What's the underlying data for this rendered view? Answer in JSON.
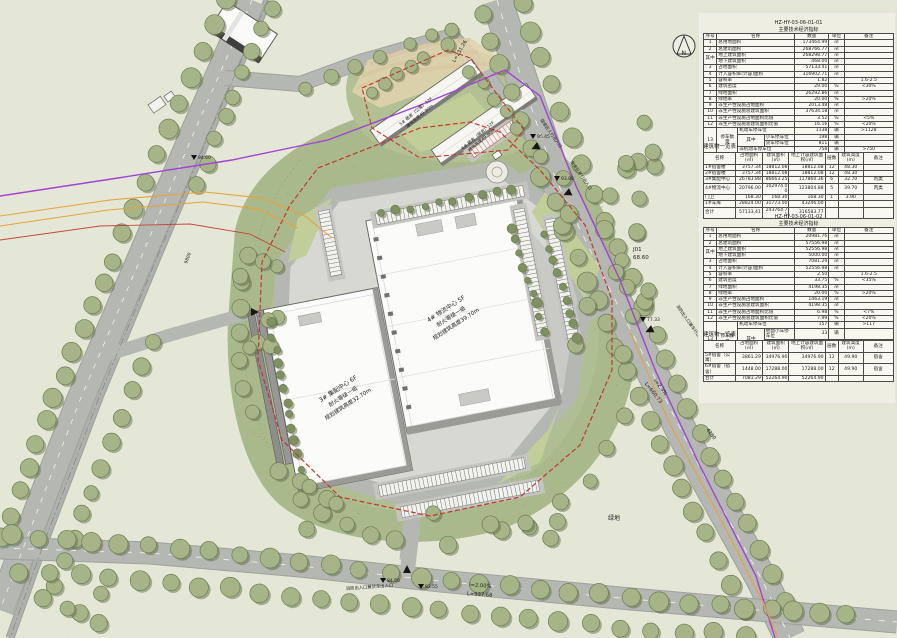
{
  "plan": {
    "north_label": "N",
    "buildings": {
      "b4": {
        "l1": "4# 物流中心 5F",
        "l2": "耐火等级一级",
        "l3": "规划建筑高度39.70m"
      },
      "b3": {
        "l1": "3# 集配中心 6F",
        "l2": "耐火等级一级",
        "l3": "规划建筑高度32.70m"
      },
      "d5": {
        "l1": "5# 宿舍（公寓）12F",
        "l2": "建筑高度49.90m"
      },
      "d6": {
        "l1": "6# 宿舍（宿舍）12F",
        "l2": "建筑高度49.90m"
      }
    },
    "roads": {
      "bottom_slope": "i=2.00%",
      "bottom_len": "L=937.68",
      "right_slope": "i=2.3%",
      "right_len": "L=660.73",
      "top_len": "L=231.26"
    },
    "points": {
      "j01": "J01",
      "j01_elev": "68.60",
      "station": "4280",
      "dim": "9800",
      "green": "绿地"
    },
    "entrances": {
      "e1": "宿舍区人行出入口",
      "e2": "宿舍区车行出入口",
      "e3": "消防出入口兼车行出入口",
      "e4": "消防出入口兼货车出入口"
    },
    "spot_elevations": [
      {
        "x": 194,
        "y": 160,
        "v": "94.60"
      },
      {
        "x": 383,
        "y": 583,
        "v": "84.50"
      },
      {
        "x": 421,
        "y": 589,
        "v": "82.55"
      },
      {
        "x": 643,
        "y": 322,
        "v": "77.33"
      },
      {
        "x": 533,
        "y": 139,
        "v": "95.45"
      },
      {
        "x": 557,
        "y": 181,
        "v": "93.88"
      }
    ]
  },
  "tables": {
    "t1": {
      "code": "HZ-HY-03-06-01-01",
      "title": "主要技术经济指标",
      "w": [
        7,
        11,
        14,
        16,
        18,
        8,
        26
      ],
      "rows": [
        {
          "h": true,
          "c": [
            {
              "t": "序号"
            },
            {
              "t": "名称",
              "cs": 3
            },
            {
              "t": "数量"
            },
            {
              "t": "单位"
            },
            {
              "t": "备注"
            }
          ]
        },
        {
          "c": [
            "1",
            {
              "t": "总用地面积",
              "cs": 3,
              "al": "l"
            },
            {
              "t": "173464.99",
              "al": "r"
            },
            "㎡",
            ""
          ]
        },
        {
          "c": [
            "2",
            {
              "t": "总建筑面积",
              "cs": 3,
              "al": "l"
            },
            {
              "t": "268766.77",
              "al": "r"
            },
            "㎡",
            ""
          ]
        },
        {
          "c": [
            {
              "t": "其中",
              "rs": 2
            },
            {
              "t": "地上建筑面积",
              "cs": 3,
              "al": "l"
            },
            {
              "t": "268298.77",
              "al": "r"
            },
            "㎡",
            ""
          ]
        },
        {
          "c": [
            {
              "t": "地下建筑面积",
              "cs": 3,
              "al": "l"
            },
            {
              "t": "468.00",
              "al": "r"
            },
            "㎡",
            ""
          ]
        },
        {
          "c": [
            "3",
            {
              "t": "占地面积",
              "cs": 3,
              "al": "l"
            },
            {
              "t": "57133.41",
              "al": "r"
            },
            "㎡",
            ""
          ]
        },
        {
          "c": [
            "4",
            {
              "t": "计入容积率(计容)面积",
              "cs": 3,
              "al": "l"
            },
            {
              "t": "316902.71",
              "al": "r"
            },
            "㎡",
            ""
          ]
        },
        {
          "c": [
            "5",
            {
              "t": "容积率",
              "cs": 3,
              "al": "l"
            },
            {
              "t": "1.82",
              "al": "r"
            },
            "",
            "1.6-2.5"
          ]
        },
        {
          "c": [
            "6",
            {
              "t": "建筑密度",
              "cs": 3,
              "al": "l"
            },
            {
              "t": "29.00",
              "al": "r"
            },
            "%",
            "<30%"
          ]
        },
        {
          "c": [
            "7",
            {
              "t": "绿地面积",
              "cs": 3,
              "al": "l"
            },
            {
              "t": "26292.86",
              "al": "r"
            },
            "㎡",
            ""
          ]
        },
        {
          "c": [
            "8",
            {
              "t": "绿地率",
              "cs": 3,
              "al": "l"
            },
            {
              "t": "20.00",
              "al": "r"
            },
            "%",
            ">20%"
          ]
        },
        {
          "c": [
            "9",
            {
              "t": "非生产性设施占地面积",
              "cs": 3,
              "al": "l"
            },
            {
              "t": "2013.48",
              "al": "r"
            },
            "㎡",
            ""
          ]
        },
        {
          "c": [
            "10",
            {
              "t": "非生产性设施总建筑面积",
              "cs": 3,
              "al": "l"
            },
            {
              "t": "37634.18",
              "al": "r"
            },
            "㎡",
            ""
          ]
        },
        {
          "c": [
            "11",
            {
              "t": "非生产性设施占地面积比值",
              "cs": 3,
              "al": "l"
            },
            {
              "t": "3.52",
              "al": "r"
            },
            "%",
            "<5%"
          ]
        },
        {
          "c": [
            "12",
            {
              "t": "非生产性设施总建筑面积比值",
              "cs": 3,
              "al": "l"
            },
            {
              "t": "16.16",
              "al": "r"
            },
            "%",
            "<20%"
          ]
        },
        {
          "c": [
            {
              "t": "13",
              "rs": 4
            },
            {
              "t": "停车数量",
              "rs": 4
            },
            {
              "t": "机动车停车位",
              "cs": 2,
              "al": "l"
            },
            {
              "t": "1138",
              "al": "r"
            },
            "辆",
            ">1128"
          ]
        },
        {
          "c": [
            {
              "t": "其中",
              "rs": 2
            },
            {
              "t": "小车停车位",
              "al": "l"
            },
            {
              "t": "198",
              "al": "r"
            },
            "辆",
            ""
          ]
        },
        {
          "c": [
            {
              "t": "货车停车位",
              "al": "l"
            },
            {
              "t": "811",
              "al": "r"
            },
            "辆",
            ""
          ]
        },
        {
          "c": [
            {
              "t": "非机动车停车位",
              "cs": 2,
              "al": "l"
            },
            {
              "t": "758",
              "al": "r"
            },
            "辆",
            ">750"
          ]
        }
      ]
    },
    "t2": {
      "caption": "建筑物一览表",
      "w": [
        17,
        14,
        14,
        19,
        7,
        13,
        16
      ],
      "rows": [
        {
          "h": true,
          "c": [
            {
              "t": "名称"
            },
            {
              "t": "占地面积(㎡)"
            },
            {
              "t": "建筑面积(㎡)"
            },
            {
              "t": "地上计容建筑面积(㎡)"
            },
            {
              "t": "层数"
            },
            {
              "t": "建筑高度(m)"
            },
            {
              "t": "备注"
            }
          ]
        },
        {
          "c": [
            {
              "t": "1#宿舍楼",
              "al": "l"
            },
            {
              "t": "3757.34",
              "al": "r"
            },
            {
              "t": "18812.08",
              "al": "r"
            },
            {
              "t": "18812.08",
              "al": "r"
            },
            "12",
            "48.30",
            ""
          ]
        },
        {
          "c": [
            {
              "t": "2#宿舍楼",
              "al": "l"
            },
            {
              "t": "3757.34",
              "al": "r"
            },
            {
              "t": "18812.08",
              "al": "r"
            },
            {
              "t": "18812.08",
              "al": "r"
            },
            "12",
            "48.30",
            ""
          ]
        },
        {
          "c": [
            {
              "t": "3#集配中心",
              "al": "l"
            },
            {
              "t": "26783.88",
              "al": "r"
            },
            {
              "t": "86663.25",
              "al": "r"
            },
            {
              "t": "117860.36",
              "al": "r"
            },
            "6",
            "32.70",
            "丙类"
          ]
        },
        {
          "c": [
            {
              "t": "4#物流中心",
              "al": "l"
            },
            {
              "t": "20796.00",
              "al": "r"
            },
            {
              "t": "102974.00",
              "al": "r"
            },
            {
              "t": "123804.88",
              "al": "r"
            },
            "5",
            "39.70",
            "丙类"
          ]
        },
        {
          "c": [
            {
              "t": "门卫",
              "al": "l"
            },
            {
              "t": "168.30",
              "al": "r"
            },
            {
              "t": "168.30",
              "al": "r"
            },
            {
              "t": "168.30",
              "al": "r"
            },
            "1",
            "3.90",
            ""
          ]
        },
        {
          "c": [
            {
              "t": "1#车库",
              "al": "l"
            },
            {
              "t": "28824.00",
              "al": "r"
            },
            {
              "t": "31773.00",
              "al": "r"
            },
            {
              "t": "43246.00",
              "al": "r"
            },
            "",
            "",
            ""
          ]
        },
        {
          "c": [
            {
              "t": "合计",
              "al": "l"
            },
            {
              "t": "57133.41",
              "al": "r"
            },
            {
              "t": "243764.71",
              "al": "r"
            },
            {
              "t": "316583.77",
              "al": "r"
            },
            "",
            "",
            ""
          ]
        }
      ]
    },
    "t3": {
      "code": "HZ-HY-03-06-01-02",
      "title": "主要技术经济指标",
      "w": [
        7,
        11,
        14,
        16,
        18,
        8,
        26
      ],
      "rows": [
        {
          "h": true,
          "c": [
            {
              "t": "序号"
            },
            {
              "t": "名称",
              "cs": 3
            },
            {
              "t": "数量"
            },
            {
              "t": "单位"
            },
            {
              "t": "备注"
            }
          ]
        },
        {
          "c": [
            "1",
            {
              "t": "总用地面积",
              "cs": 3,
              "al": "l"
            },
            {
              "t": "20981.76",
              "al": "r"
            },
            "㎡",
            ""
          ]
        },
        {
          "c": [
            "2",
            {
              "t": "总建筑面积",
              "cs": 3,
              "al": "l"
            },
            {
              "t": "57556.98",
              "al": "r"
            },
            "㎡",
            ""
          ]
        },
        {
          "c": [
            {
              "t": "其中",
              "rs": 2
            },
            {
              "t": "地上建筑面积",
              "cs": 3,
              "al": "l"
            },
            {
              "t": "52556.98",
              "al": "r"
            },
            "㎡",
            ""
          ]
        },
        {
          "c": [
            {
              "t": "地下建筑面积",
              "cs": 3,
              "al": "l"
            },
            {
              "t": "5000.00",
              "al": "r"
            },
            "㎡",
            ""
          ]
        },
        {
          "c": [
            "3",
            {
              "t": "占地面积",
              "cs": 3,
              "al": "l"
            },
            {
              "t": "7081.29",
              "al": "r"
            },
            "㎡",
            ""
          ]
        },
        {
          "c": [
            "4",
            {
              "t": "计入容积率(计容)面积",
              "cs": 3,
              "al": "l"
            },
            {
              "t": "52556.98",
              "al": "r"
            },
            "㎡",
            ""
          ]
        },
        {
          "c": [
            "5",
            {
              "t": "容积率",
              "cs": 3,
              "al": "l"
            },
            {
              "t": "2.50",
              "al": "r"
            },
            "",
            "1.6-2.5"
          ]
        },
        {
          "c": [
            "6",
            {
              "t": "建筑密度",
              "cs": 3,
              "al": "l"
            },
            {
              "t": "33.75",
              "al": "r"
            },
            "%",
            "<35%"
          ]
        },
        {
          "c": [
            "7",
            {
              "t": "绿地面积",
              "cs": 3,
              "al": "l"
            },
            {
              "t": "4198.35",
              "al": "r"
            },
            "㎡",
            ""
          ]
        },
        {
          "c": [
            "8",
            {
              "t": "绿地率",
              "cs": 3,
              "al": "l"
            },
            {
              "t": "20.00",
              "al": "r"
            },
            "%",
            ">20%"
          ]
        },
        {
          "c": [
            "9",
            {
              "t": "非生产性设施占地面积",
              "cs": 3,
              "al": "l"
            },
            {
              "t": "1463.19",
              "al": "r"
            },
            "㎡",
            ""
          ]
        },
        {
          "c": [
            "10",
            {
              "t": "非生产性设施总建筑面积",
              "cs": 3,
              "al": "l"
            },
            {
              "t": "4198.35",
              "al": "r"
            },
            "㎡",
            ""
          ]
        },
        {
          "c": [
            "11",
            {
              "t": "非生产性设施占地面积比值",
              "cs": 3,
              "al": "l"
            },
            {
              "t": "6.98",
              "al": "r"
            },
            "%",
            "<7%"
          ]
        },
        {
          "c": [
            "12",
            {
              "t": "非生产性设施总建筑面积比值",
              "cs": 3,
              "al": "l"
            },
            {
              "t": "7.99",
              "al": "r"
            },
            "%",
            "<20%"
          ]
        },
        {
          "c": [
            {
              "t": "13",
              "rs": 4
            },
            {
              "t": "停车数量",
              "rs": 4
            },
            {
              "t": "机动车停车位",
              "cs": 2,
              "al": "l"
            },
            {
              "t": "157",
              "al": "r"
            },
            "辆",
            ">117"
          ]
        },
        {
          "c": [
            {
              "t": "其中",
              "rs": 2
            },
            {
              "t": "地面小车停车位",
              "al": "l"
            },
            {
              "t": "33",
              "al": "r"
            },
            "辆",
            ""
          ]
        },
        {
          "c": [
            {
              "t": "地下小车停车位",
              "al": "l"
            },
            {
              "t": "124",
              "al": "r"
            },
            "辆",
            ""
          ]
        },
        {
          "c": [
            {
              "t": "非机动车停车位",
              "cs": 2,
              "al": "l"
            },
            {
              "t": "262",
              "al": "r"
            },
            "辆",
            ">262"
          ]
        }
      ]
    },
    "t4": {
      "caption": "建筑物一览表",
      "w": [
        17,
        14,
        14,
        19,
        7,
        13,
        16
      ],
      "rows": [
        {
          "h": true,
          "c": [
            {
              "t": "名称"
            },
            {
              "t": "占地面积(㎡)"
            },
            {
              "t": "建筑面积(㎡)"
            },
            {
              "t": "地上计容建筑面积(㎡)"
            },
            {
              "t": "层数"
            },
            {
              "t": "建筑高度(m)"
            },
            {
              "t": "备注"
            }
          ]
        },
        {
          "c": [
            {
              "t": "5#宿舍（公寓）",
              "al": "l"
            },
            {
              "t": "3861.29",
              "al": "r"
            },
            {
              "t": "34976.90",
              "al": "r"
            },
            {
              "t": "34976.90",
              "al": "r"
            },
            "12",
            "49.90",
            "宿舍"
          ]
        },
        {
          "c": [
            {
              "t": "6#宿舍（宿舍）",
              "al": "l"
            },
            {
              "t": "1448.00",
              "al": "r"
            },
            {
              "t": "17288.00",
              "al": "r"
            },
            {
              "t": "17288.00",
              "al": "r"
            },
            "12",
            "49.90",
            "宿舍"
          ]
        },
        {
          "c": [
            {
              "t": "合计",
              "al": "l"
            },
            {
              "t": "7081.29",
              "al": "r"
            },
            {
              "t": "52264.90",
              "al": "r"
            },
            {
              "t": "52264.90",
              "al": "r"
            },
            "",
            "",
            ""
          ]
        }
      ]
    }
  }
}
